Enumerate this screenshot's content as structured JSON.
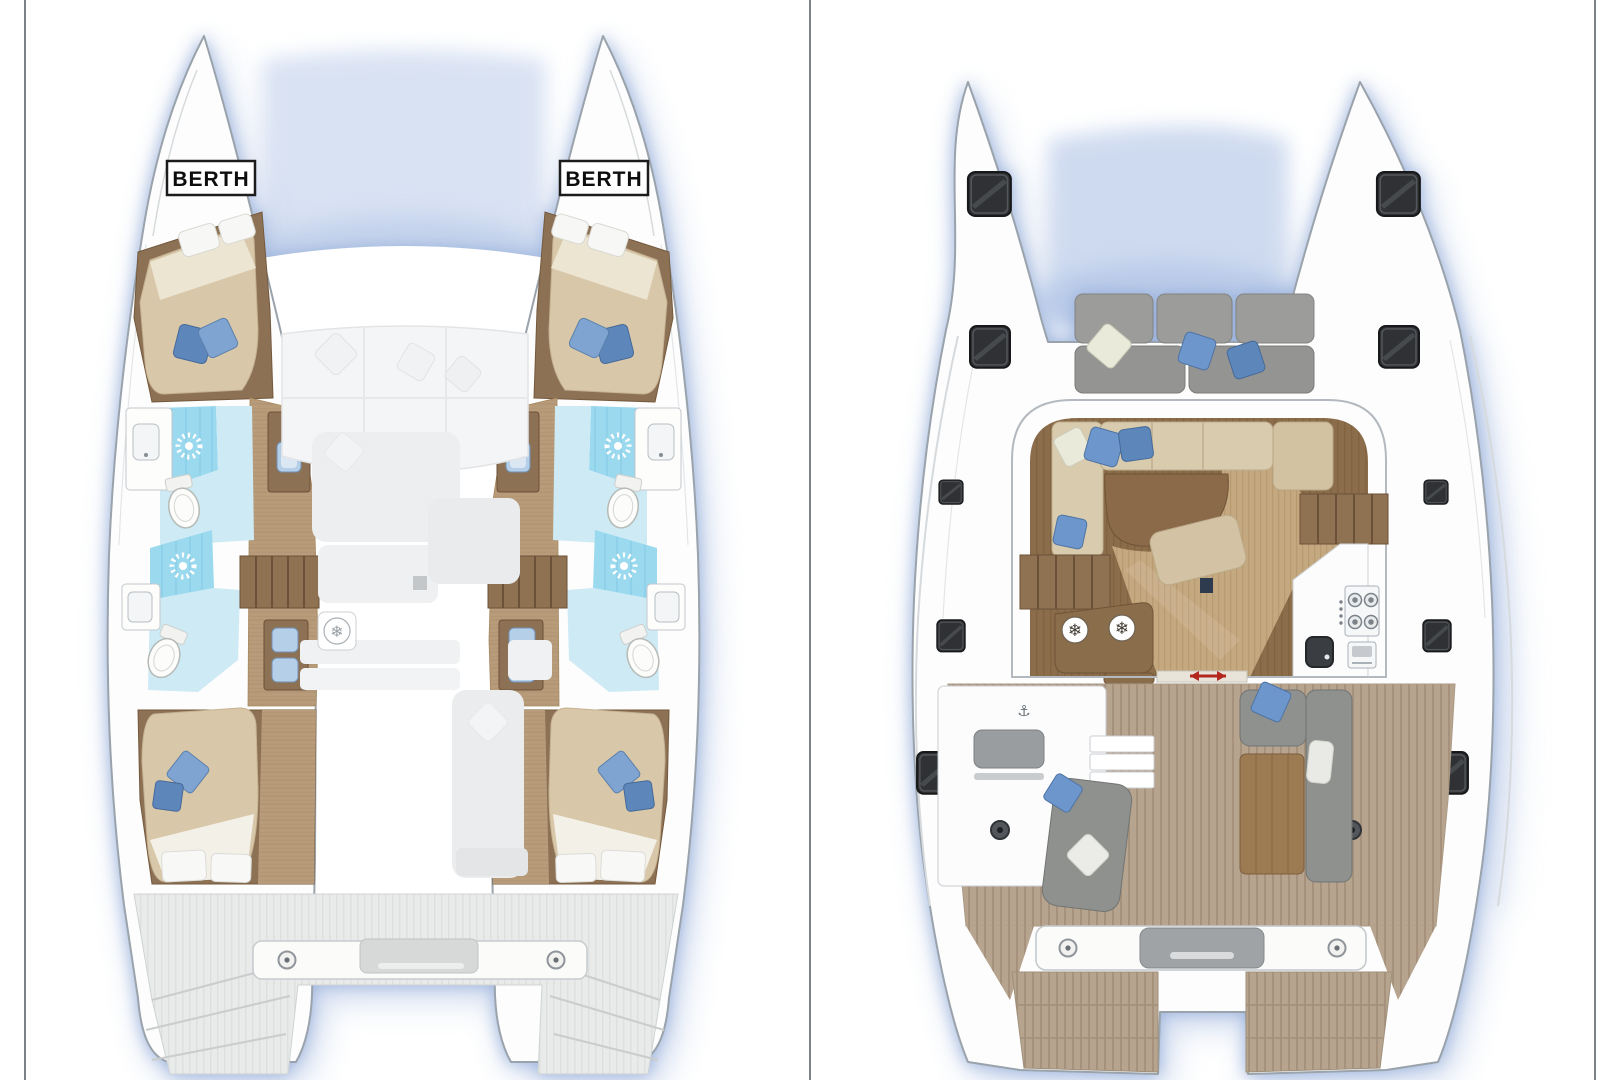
{
  "page": {
    "width": 1620,
    "height": 1080,
    "background": "#ffffff",
    "frame_color": "#7d8287"
  },
  "left_panel": {
    "name": "lower deck plan",
    "port_berth_label": "BERTH",
    "starboard_berth_label": "BERTH",
    "features": {
      "cabins": 4,
      "bathrooms": 4,
      "shower_icons": 4,
      "toilets": 4,
      "vanity_sinks": 6,
      "stair_flights": 2,
      "forepeak_berths": 2,
      "fridge_icons": 1
    }
  },
  "right_panel": {
    "name": "main deck plan",
    "features": {
      "hull_hatches": 10,
      "bow_cockpit_cushions": 6,
      "fridge_icons": 2,
      "stove_burners": 4,
      "galley": [
        "stove",
        "oven",
        "sink"
      ],
      "cockpit": [
        "helm-bench",
        "steps",
        "chaise-lounge",
        "l-sofa",
        "table",
        "speakers"
      ],
      "transom": [
        "crossbeam",
        "cleats",
        "swim-platforms"
      ]
    }
  },
  "icons": {
    "fridge_glyph": "❄",
    "anchor_glyph": "⚓"
  },
  "colors": {
    "hull_outline": "#9aa3ab",
    "glow": "#9db4dd",
    "wood_dark": "#8d7154",
    "wood_floor": "#b89c7a",
    "wood_table": "#9c7a52",
    "salon_floor_dark": "#8b6d4c",
    "salon_floor_light": "#c4a87f",
    "mattress": "#d8c8a9",
    "pillow_blue": "#7fa4d2",
    "pillow_blue_dark": "#5d87bb",
    "pillow_white": "#f7f7f5",
    "pillow_sage": "#e9ead9",
    "shower": "#9ad9ee",
    "bath_floor": "#cdeaf5",
    "sink_blue": "#b6cfe9",
    "cushion_gray": "#9c9c9a",
    "sofa_beige": "#d9cbae",
    "teak": "#b7a48e",
    "deck_gray": "#e9eaea",
    "hatch": "#2f3134",
    "door_arrow_red": "#b3281e"
  }
}
